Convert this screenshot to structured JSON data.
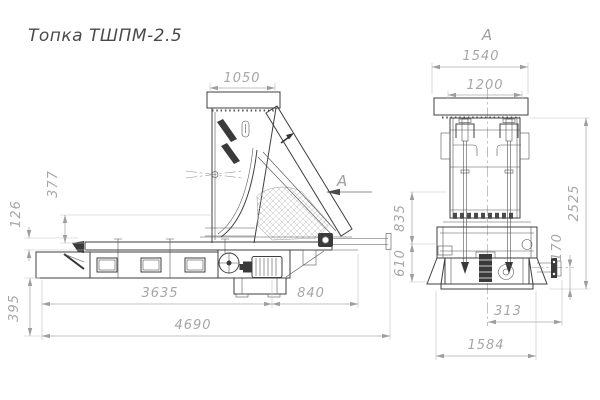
{
  "title": "Топка ТШПМ-2.5",
  "section": {
    "arrow_label": "А",
    "view_label": "А"
  },
  "dimensions": {
    "side": {
      "hopper_top_width": "1050",
      "hopper_height": "377",
      "grate_height": "126",
      "base_depth": "395",
      "conveyor_length": "3635",
      "drive_length": "840",
      "overall_length": "4690"
    },
    "front": {
      "top_frame_width": "1540",
      "hopper_opening_width": "1200",
      "mid_height": "835",
      "lower_height": "610",
      "overall_height": "2525",
      "shaft_axis_height": "170",
      "shaft_offset": "313",
      "base_width": "1584"
    }
  },
  "colors": {
    "background": "#ffffff",
    "outline": "#3f3f3f",
    "dimension": "#a6a6a6",
    "title_text": "#4a4a4a"
  }
}
